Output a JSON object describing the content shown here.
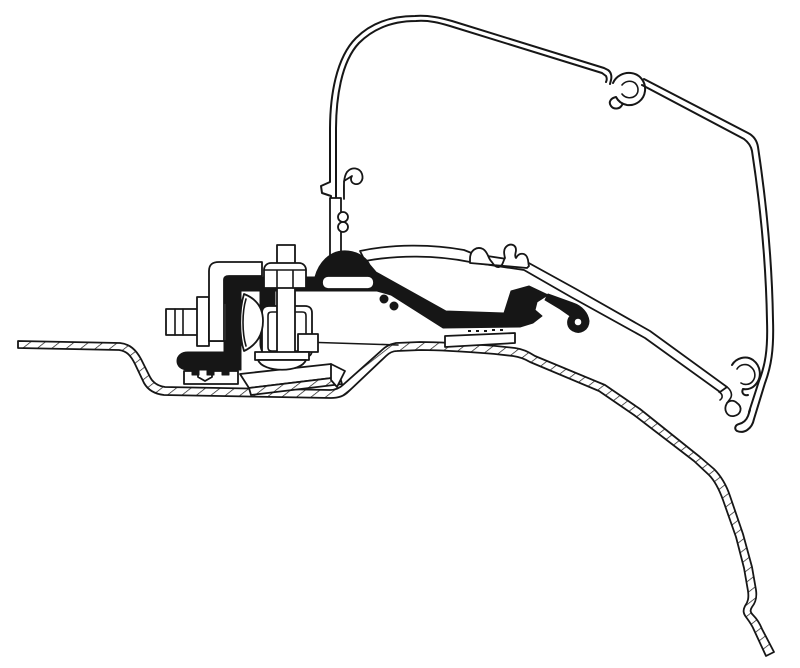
{
  "page": {
    "background": "#ffffff",
    "title": "Awning adapter bracket cross-section"
  },
  "drawing": {
    "title": "Technical cross-section drawing of an awning mounting adapter bracket clamped to a van roof profile",
    "ink_color": "#161616",
    "paper_color": "#ffffff",
    "style": "black-and-white line art, no text labels",
    "components": [
      "awning-case-profile",
      "awning-rail-hook",
      "awning-lower-arm",
      "adapter-profile-black",
      "mounting-bracket-hardware",
      "vertical-clamp-bolt",
      "horizontal-clamp-bolt",
      "serrated-clamp-foot",
      "adapter-base-plate",
      "van-roof-panel"
    ]
  }
}
